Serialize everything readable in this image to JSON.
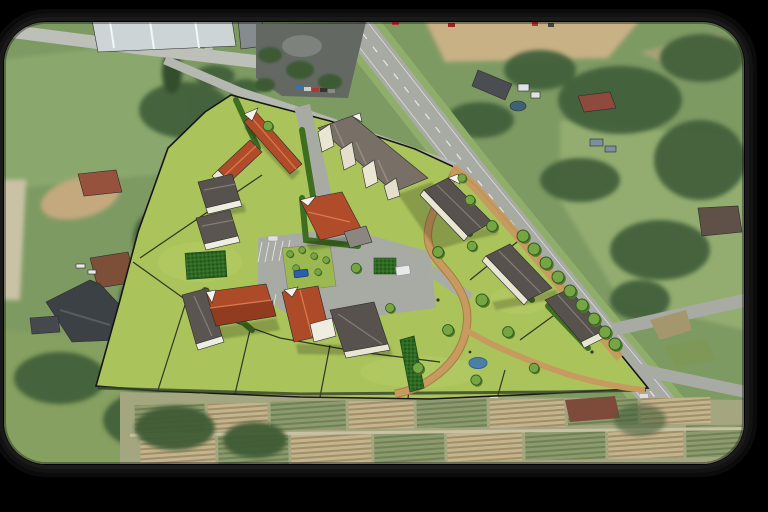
{
  "image": {
    "kind": "aerial-photomontage",
    "subject": "3D architectural site-plan rendering of a small housing development composited onto an aerial photograph",
    "width_px": 768,
    "height_px": 512,
    "visible_text": "none"
  },
  "frame": {
    "background": "#000000",
    "photo_corner_radius_px": 42,
    "border_effect": "stacked dark rounded rings (drop-shadow style)"
  },
  "palette": {
    "background": "#000000",
    "grass_base": "#7e9a63",
    "grass_light": "#8fae6a",
    "tree_dark": "#42603a",
    "road_asphalt": "#a8aba4",
    "road_local": "#bdc0b8",
    "road_verge": "#8fae6a",
    "parking_asphalt": "#636862",
    "bare_soil": "#c8b185",
    "allotment_green": "#8d9a6f",
    "allotment_tan": "#c3b48e",
    "lawn_render": "#aac35b",
    "lawn_render_light": "#b7cd67",
    "hedge_green": "#3e6e20",
    "hedge_hatch": "#2f6a25",
    "path_tan": "#c79a5f",
    "roof_red": "#b04c2a",
    "roof_red_dark": "#8f3a1e",
    "roof_gray": "#57524d",
    "roof_brown_gray": "#786f66",
    "wall_cream": "#eae6d4",
    "water_blue": "#4c7fa6",
    "industrial_roof": "#ccd4d6",
    "car_blue": "#2a5fae",
    "van_white": "#e9e9e9"
  },
  "scene": {
    "base_layer": "aerial/satellite photo: roads, industrial hall, parking lot, farm houses, barns, hedgerows, woodland, allotment garden rows",
    "overlay_layer": "3D massing model: lime-green plots with black boundary lines, red- and gray-roofed houses, rowhouses, hedges, tan footpaths, central paved courtyard with parking, street trees",
    "features": [
      {
        "name": "main-road",
        "description": "wide diagonal road crossing from top-center to bottom-right with lane markings"
      },
      {
        "name": "frontage-street",
        "description": "local street along the top edge of the development"
      },
      {
        "name": "industrial-hall",
        "description": "large white-roofed building at top-left"
      },
      {
        "name": "parking-lot",
        "description": "dark asphalt car park with trees and parked cars, top-center"
      },
      {
        "name": "development-site",
        "description": "lime-green landscaped site bounded by a black outline"
      },
      {
        "name": "red-roof-buildings",
        "description": "four red/terracotta roofed buildings in the development"
      },
      {
        "name": "gray-roof-rowhouses",
        "description": "gray-roofed rowhouse blocks parallel to the main road"
      },
      {
        "name": "central-courtyard",
        "description": "paved plaza with parking bays, planted island, blue car and white van"
      },
      {
        "name": "winding-paths",
        "description": "tan pedestrian paths curving through the green space"
      },
      {
        "name": "street-tree-row",
        "description": "row of rendered trees along the main road edge"
      },
      {
        "name": "pond",
        "description": "small blue pond in the lower green area"
      },
      {
        "name": "allotment-gardens",
        "description": "striped crop/garden plots along the bottom of the photo"
      },
      {
        "name": "woodland",
        "description": "dense tree masses on the right side and lower left"
      }
    ]
  }
}
